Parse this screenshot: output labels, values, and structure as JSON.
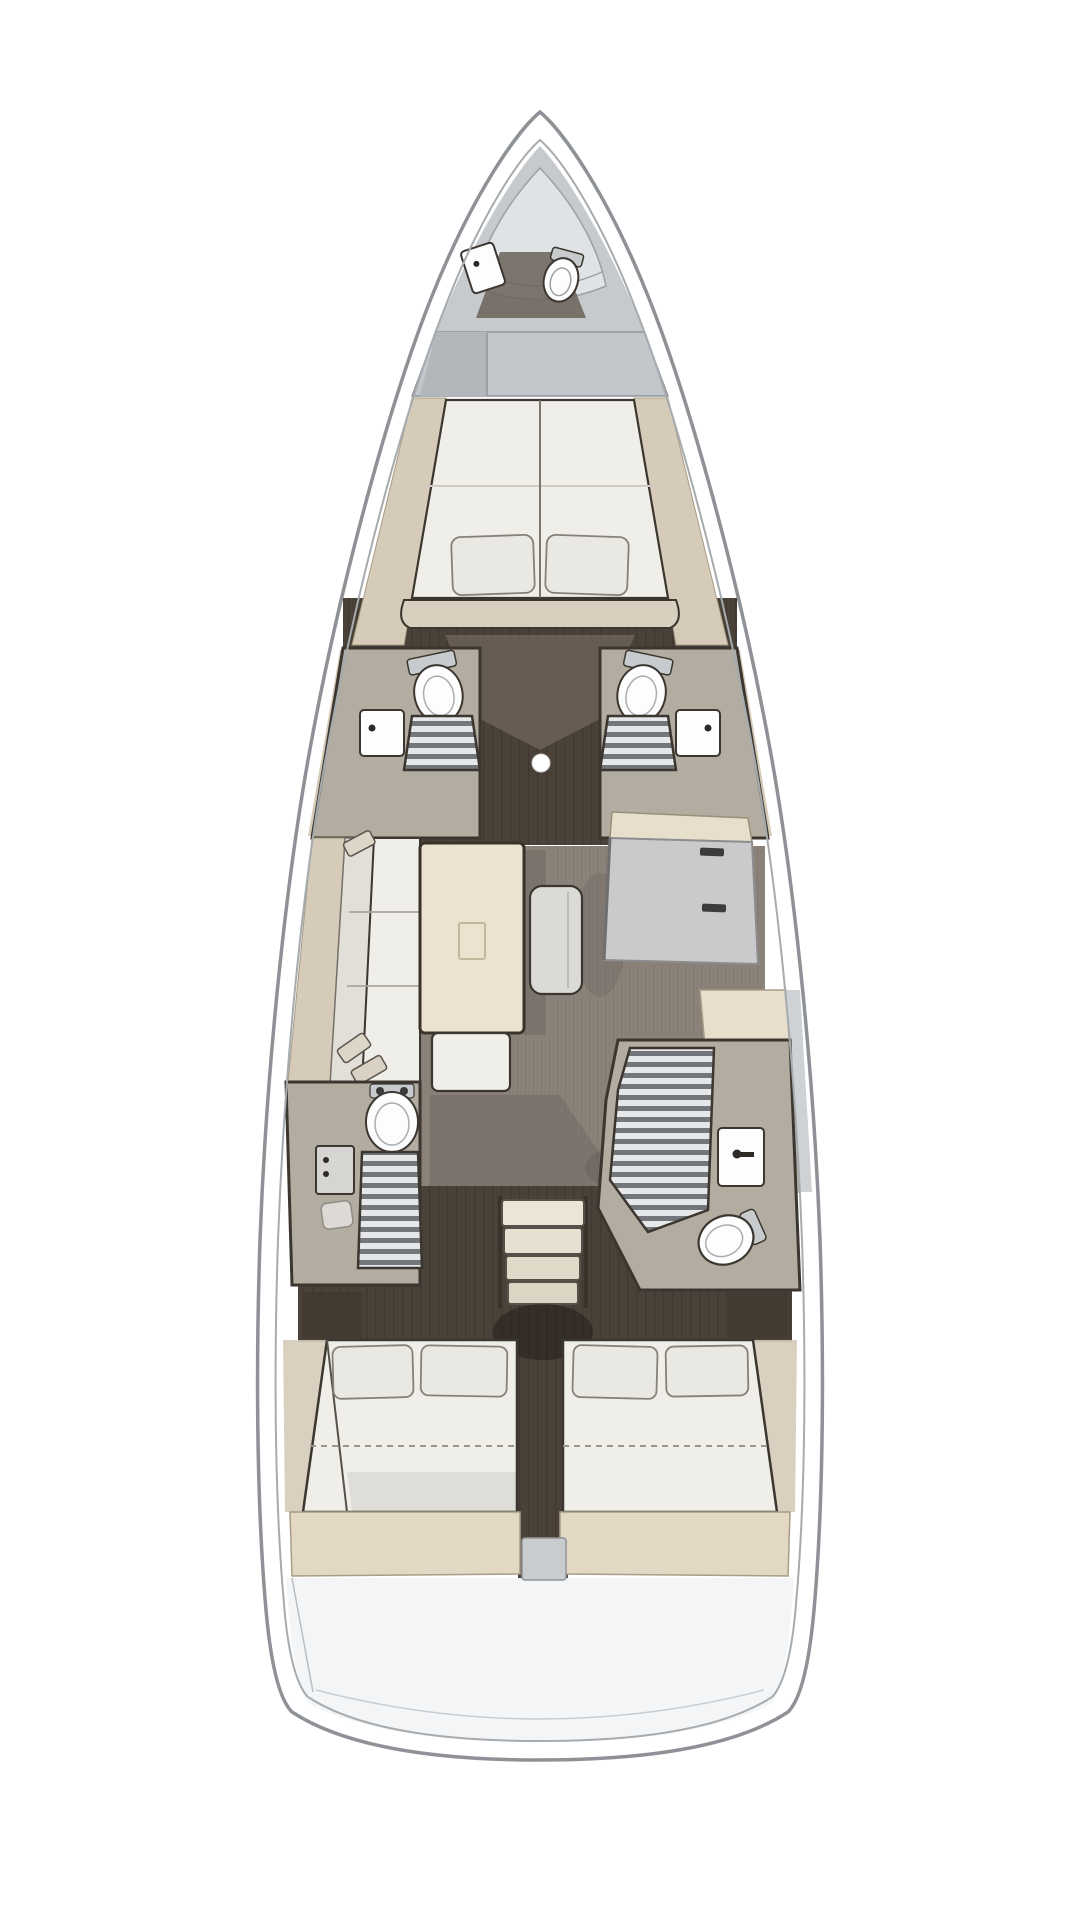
{
  "page": {
    "title": "Sailing yacht interior floor plan — top view, bow up"
  },
  "diagram": {
    "type": "floor-plan",
    "subject": "Sailing yacht interior layout, top-down view, bow at top",
    "rooms": [
      {
        "id": "forepeak",
        "label": "Forepeak with sail locker, crew toilet and sink"
      },
      {
        "id": "forward-cabin",
        "label": "Forward cabin with island double berth and two pillows"
      },
      {
        "id": "forward-head-port",
        "label": "Port forward head: toilet, shower grating, sink"
      },
      {
        "id": "forward-head-starboard",
        "label": "Starboard forward head: toilet, shower grating, sink"
      },
      {
        "id": "salon",
        "label": "Salon with port settee, dining table, bench and ottoman"
      },
      {
        "id": "galley",
        "label": "Starboard galley cabinets and counter"
      },
      {
        "id": "aft-head-port",
        "label": "Port aft head: toilet, long shower grating, sink"
      },
      {
        "id": "aft-head-starboard",
        "label": "Starboard aft head: shower grating, vanity sink, toilet"
      },
      {
        "id": "companionway",
        "label": "Companionway steps between aft cabins"
      },
      {
        "id": "aft-cabin-port",
        "label": "Port aft cabin with double berth and two pillows"
      },
      {
        "id": "aft-cabin-starboard",
        "label": "Starboard aft cabin with double berth and two pillows"
      },
      {
        "id": "stern",
        "label": "Transom / lazarette storage"
      }
    ],
    "features": [
      "mast step dot between forward heads",
      "4 toilets",
      "4 shower gratings",
      "3 double berths",
      "6 pillows",
      "dining table with folding-leaf detail",
      "ottoman",
      "companionway steps (4 treads)"
    ],
    "palette": {
      "page_bg": "#ffffff",
      "hull_stroke": "#8e9296",
      "hull_inner": "#a6abaf",
      "deck_gray": "#c6cacd",
      "deck_gray_light": "#e0e3e5",
      "bulkhead_gray": "#c3c7cb",
      "shelf_tan": "#d5cbb8",
      "shelf_tan_edge": "#a79c85",
      "cushion": "#f0eee9",
      "cushion_shade": "#e2dfd8",
      "pillow": "#eae8e3",
      "pillow_edge": "#85817a",
      "outline": "#3b362f",
      "walnut": "#4a4138",
      "walnut_line": "#3e362e",
      "oak": "#8b837a",
      "oak_line": "#7f776e",
      "head_floor": "#b2aca1",
      "fixture": "#fdfdfd",
      "fixture_gray": "#c7cbcd",
      "grate_light": "#e6e7e8",
      "grate_dark": "#73767a",
      "table_cream": "#ebe3d0",
      "table_edge": "#3a332b",
      "ottoman": "#dcdad6",
      "cabinet_top": "#e7decc",
      "cabinet_face": "#cacacc",
      "handle_dark": "#3c3c3c",
      "band_beige": "#e2d8c4",
      "band_edge": "#a89d86",
      "stern_fill": "#f4f5f6",
      "step_gray": "#c9ccce",
      "mast_white": "#ffffff"
    }
  }
}
